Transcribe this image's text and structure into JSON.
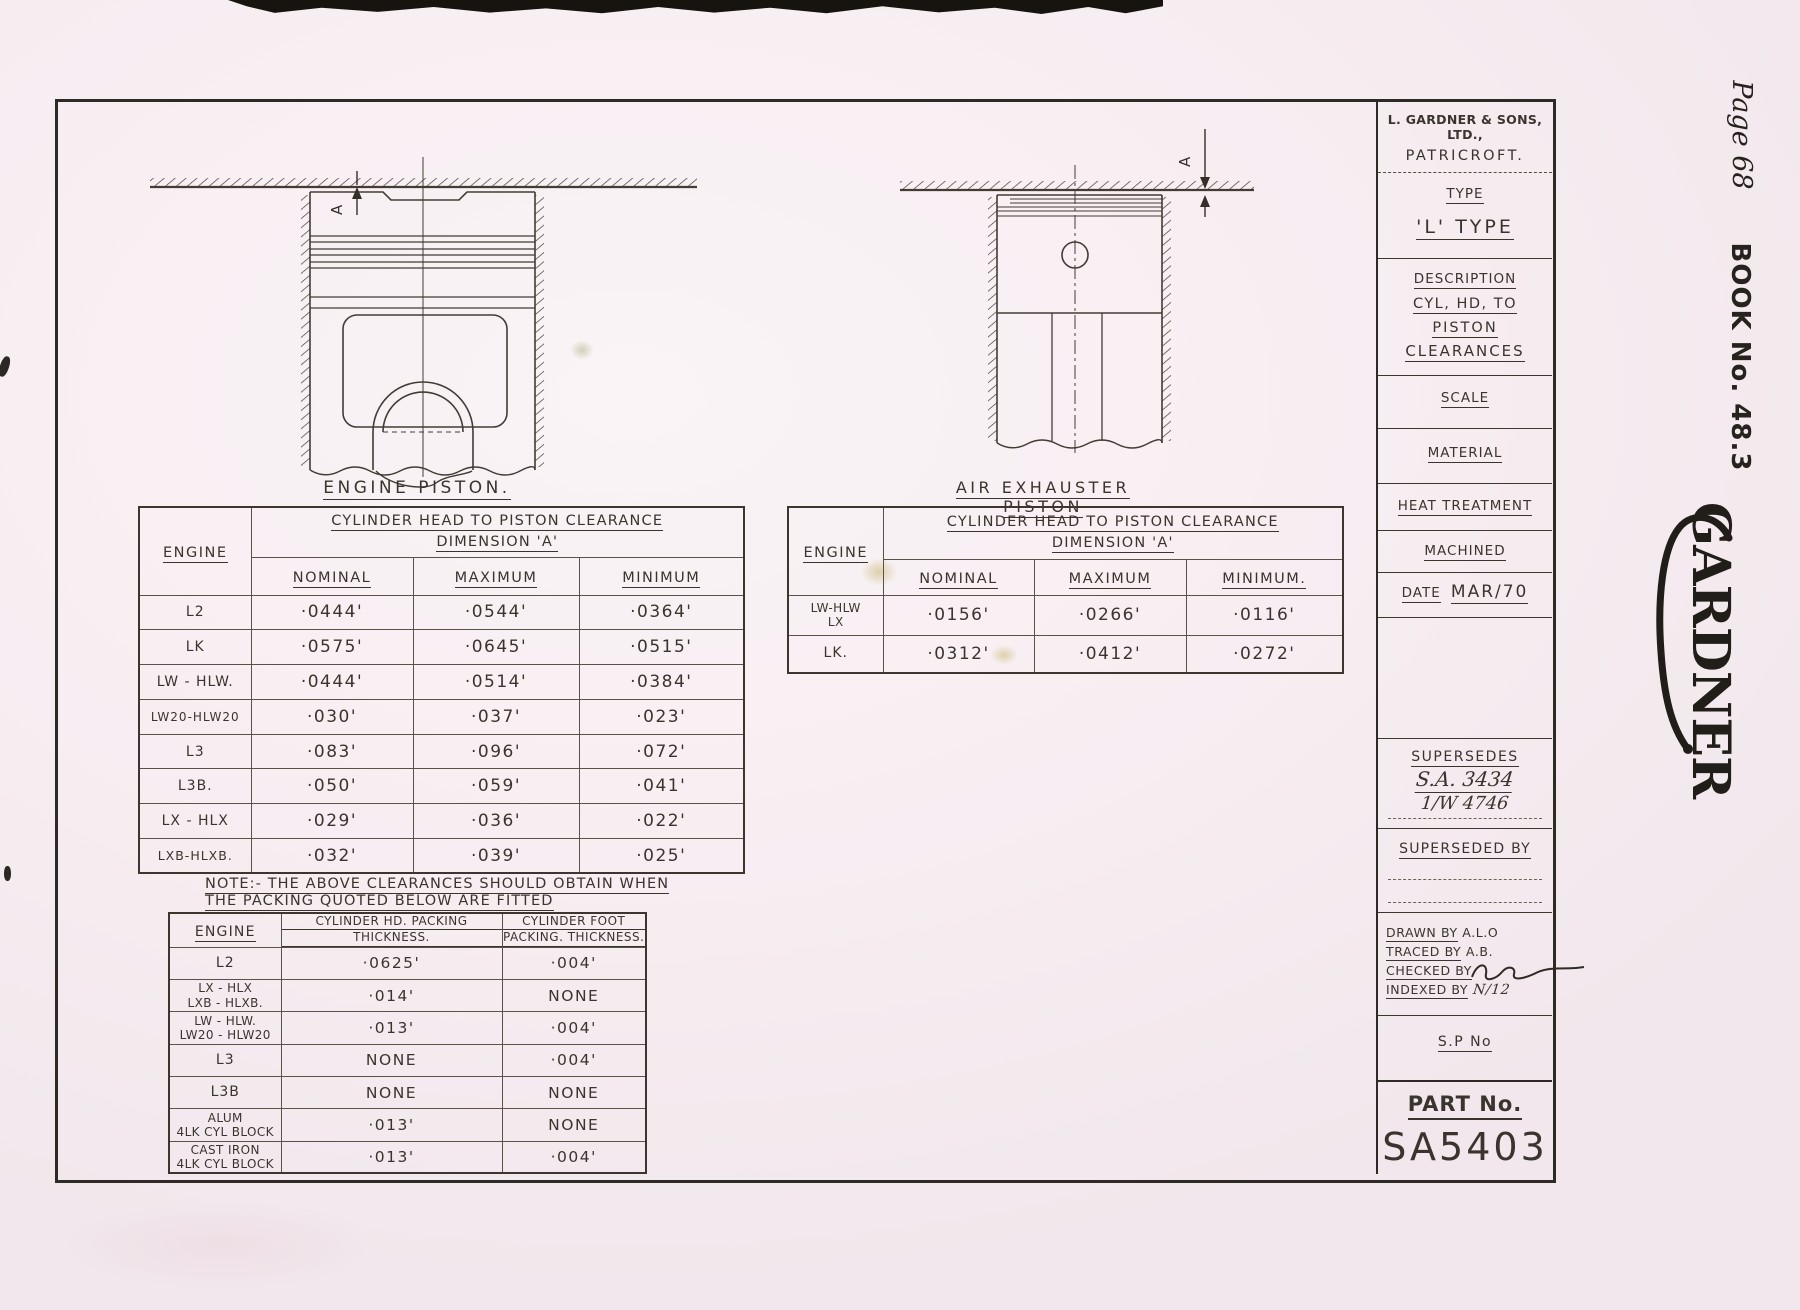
{
  "page": {
    "page_label": "Page 68",
    "book_label": "BOOK No. 48.3",
    "logo_text": "GARDNER",
    "colors": {
      "paper": "#f6edf1",
      "ink": "#3a342e"
    }
  },
  "drawings": {
    "engine_piston": {
      "caption": "ENGINE PISTON.",
      "dim_label": "A"
    },
    "air_exhauster": {
      "caption": "AIR EXHAUSTER PISTON",
      "dim_label": "A"
    }
  },
  "engine_table": {
    "engine_col_header": "ENGINE",
    "span_header": [
      "CYLINDER HEAD TO PISTON CLEARANCE",
      "DIMENSION 'A'"
    ],
    "col_headers": [
      "NOMINAL",
      "MAXIMUM",
      "MINIMUM"
    ],
    "rows": [
      {
        "engine": "L2",
        "nominal": "·0444'",
        "maximum": "·0544'",
        "minimum": "·0364'"
      },
      {
        "engine": "LK",
        "nominal": "·0575'",
        "maximum": "·0645'",
        "minimum": "·0515'"
      },
      {
        "engine": "LW - HLW.",
        "nominal": "·0444'",
        "maximum": "·0514'",
        "minimum": "·0384'"
      },
      {
        "engine": "LW20-HLW20",
        "nominal": "·030'",
        "maximum": "·037'",
        "minimum": "·023'"
      },
      {
        "engine": "L3",
        "nominal": "·083'",
        "maximum": "·096'",
        "minimum": "·072'"
      },
      {
        "engine": "L3B.",
        "nominal": "·050'",
        "maximum": "·059'",
        "minimum": "·041'"
      },
      {
        "engine": "LX - HLX",
        "nominal": "·029'",
        "maximum": "·036'",
        "minimum": "·022'"
      },
      {
        "engine": "LXB-HLXB.",
        "nominal": "·032'",
        "maximum": "·039'",
        "minimum": "·025'"
      }
    ]
  },
  "exhauster_table": {
    "engine_col_header": "ENGINE",
    "span_header": [
      "CYLINDER HEAD TO PISTON CLEARANCE",
      "DIMENSION 'A'"
    ],
    "col_headers": [
      "NOMINAL",
      "MAXIMUM",
      "MINIMUM."
    ],
    "rows": [
      {
        "engine_lines": [
          "LW-HLW",
          "LX"
        ],
        "nominal": "·0156'",
        "maximum": "·0266'",
        "minimum": "·0116'"
      },
      {
        "engine_lines": [
          "LK."
        ],
        "nominal": "·0312'",
        "maximum": "·0412'",
        "minimum": "·0272'"
      }
    ]
  },
  "note": {
    "line1": "NOTE:- THE ABOVE CLEARANCES SHOULD OBTAIN WHEN",
    "line2": "THE PACKING QUOTED BELOW ARE FITTED"
  },
  "packing_table": {
    "engine_col_header": "ENGINE",
    "head_col_header": [
      "CYLINDER HD. PACKING",
      "THICKNESS."
    ],
    "foot_col_header": [
      "CYLINDER FOOT",
      "PACKING. THICKNESS."
    ],
    "rows": [
      {
        "engine_lines": [
          "L2"
        ],
        "head": "·0625'",
        "foot": "·004'"
      },
      {
        "engine_lines": [
          "LX - HLX",
          "LXB - HLXB."
        ],
        "head": "·014'",
        "foot": "NONE"
      },
      {
        "engine_lines": [
          "LW - HLW.",
          "LW20 - HLW20"
        ],
        "head": "·013'",
        "foot": "·004'"
      },
      {
        "engine_lines": [
          "L3"
        ],
        "head": "NONE",
        "foot": "·004'"
      },
      {
        "engine_lines": [
          "L3B"
        ],
        "head": "NONE",
        "foot": "NONE"
      },
      {
        "engine_lines": [
          "ALUM",
          "4LK CYL BLOCK"
        ],
        "head": "·013'",
        "foot": "NONE"
      },
      {
        "engine_lines": [
          "CAST IRON",
          "4LK CYL BLOCK"
        ],
        "head": "·013'",
        "foot": "·004'"
      }
    ]
  },
  "title_block": {
    "company_line1": "L. GARDNER & SONS, LTD.,",
    "company_line2": "PATRICROFT.",
    "type_label": "TYPE",
    "type_value": "'L' TYPE",
    "description_label": "DESCRIPTION",
    "description_line1": "CYL, HD, TO",
    "description_line2": "PISTON",
    "description_line3": "CLEARANCES",
    "scale_label": "SCALE",
    "material_label": "MATERIAL",
    "heat_treatment_label": "HEAT TREATMENT",
    "machined_label": "MACHINED",
    "date_label": "DATE",
    "date_value": "MAR/70",
    "supersedes_label": "SUPERSEDES",
    "supersedes_value1": "S.A. 3434",
    "supersedes_value2": "1/W 4746",
    "superseded_by_label": "SUPERSEDED BY",
    "drawn_by_label": "DRAWN BY",
    "drawn_by_value": "A.L.O",
    "traced_by_label": "TRACED BY",
    "traced_by_value": "A.B.",
    "checked_by_label": "CHECKED BY",
    "indexed_by_label": "INDEXED BY",
    "indexed_by_value": "N/12",
    "sp_no_label": "S.P No",
    "part_no_label": "PART No.",
    "part_no_value": "SA5403"
  }
}
